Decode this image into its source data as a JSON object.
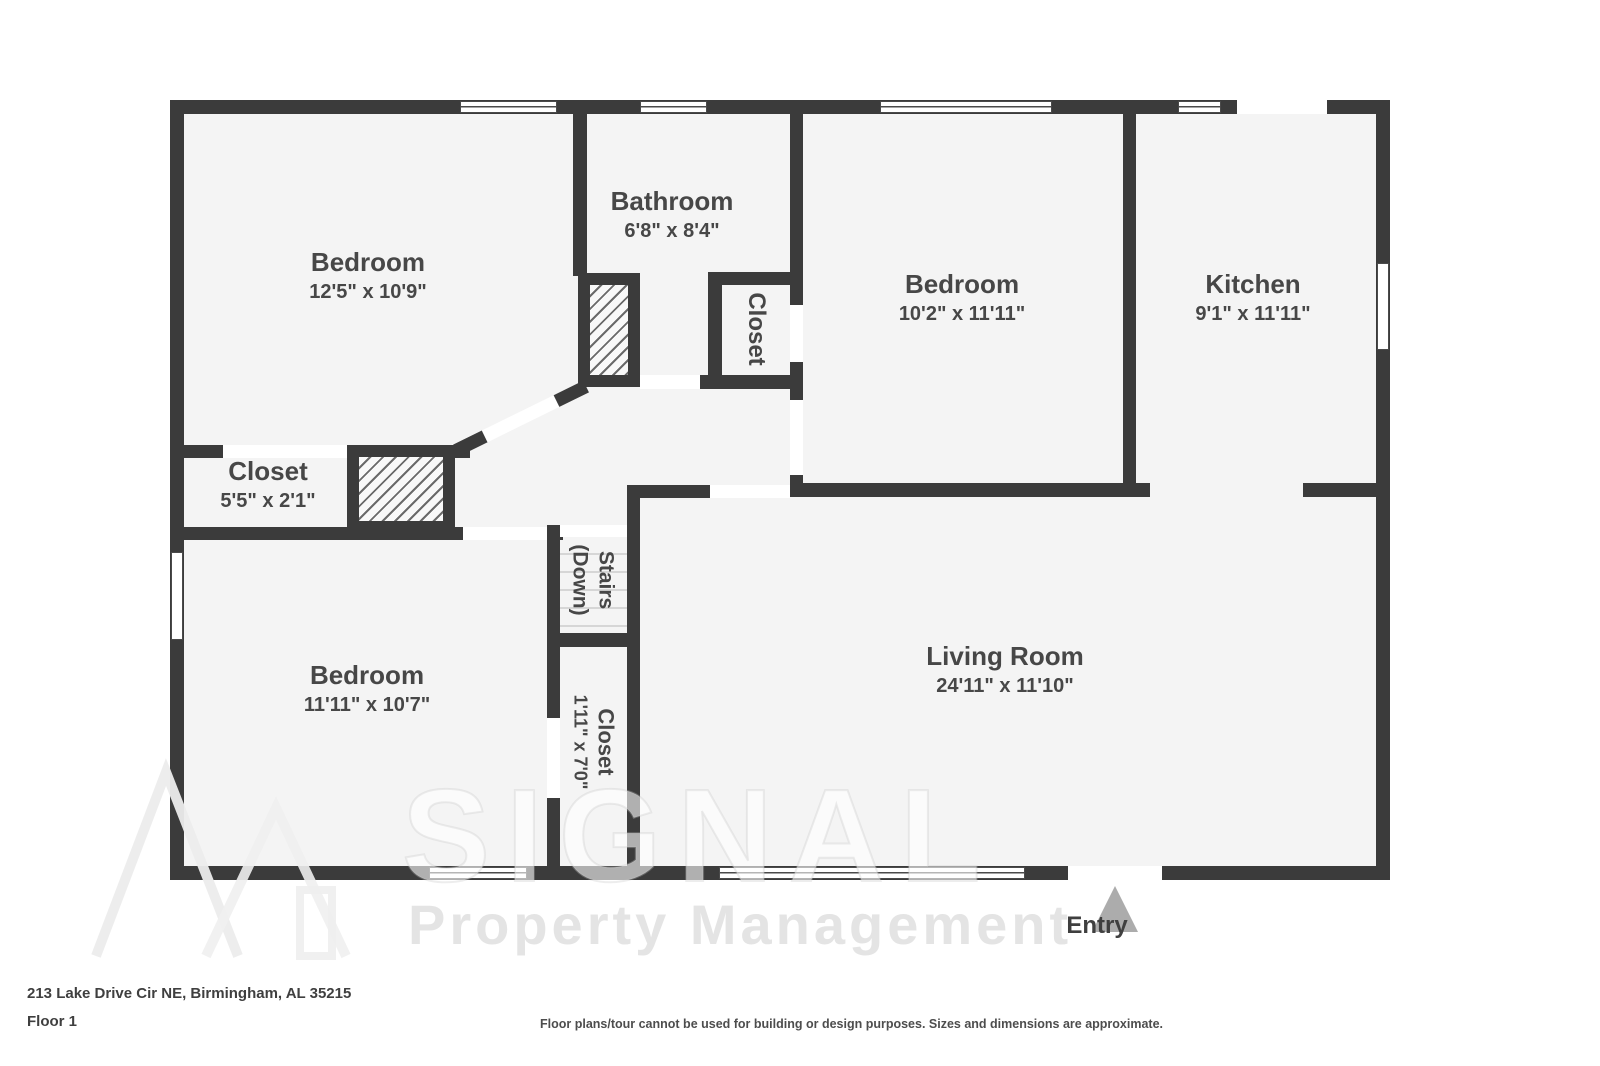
{
  "address": "213 Lake Drive Cir NE, Birmingham, AL 35215",
  "floor_label": "Floor 1",
  "disclaimer": "Floor plans/tour cannot be used for building or design purposes. Sizes and dimensions are approximate.",
  "entry_label": "Entry",
  "watermark": {
    "brand": "SIGNAL",
    "tagline": "Property Management"
  },
  "colors": {
    "wall": "#3b3b3b",
    "floor": "#f4f4f4",
    "opening": "#ffffff",
    "label_text": "#474747",
    "entry_arrow": "#acacac",
    "stair_tread": "#d6d6d6"
  },
  "rooms": {
    "bedroom_top_left": {
      "name": "Bedroom",
      "dimensions": "12'5\" x 10'9\""
    },
    "bathroom": {
      "name": "Bathroom",
      "dimensions": "6'8\" x 8'4\""
    },
    "closet_bathroom": {
      "name": "Closet"
    },
    "bedroom_top_middle": {
      "name": "Bedroom",
      "dimensions": "10'2\" x 11'11\""
    },
    "kitchen": {
      "name": "Kitchen",
      "dimensions": "9'1\" x 11'11\""
    },
    "closet_left": {
      "name": "Closet",
      "dimensions": "5'5\" x 2'1\""
    },
    "bedroom_bottom_left": {
      "name": "Bedroom",
      "dimensions": "11'11\" x 10'7\""
    },
    "stairs": {
      "name": "Stairs",
      "qualifier": "(Down)"
    },
    "closet_middle": {
      "name": "Closet",
      "dimensions": "1'11\" x 7'0\""
    },
    "living_room": {
      "name": "Living Room",
      "dimensions": "24'11\" x 11'10\""
    }
  }
}
